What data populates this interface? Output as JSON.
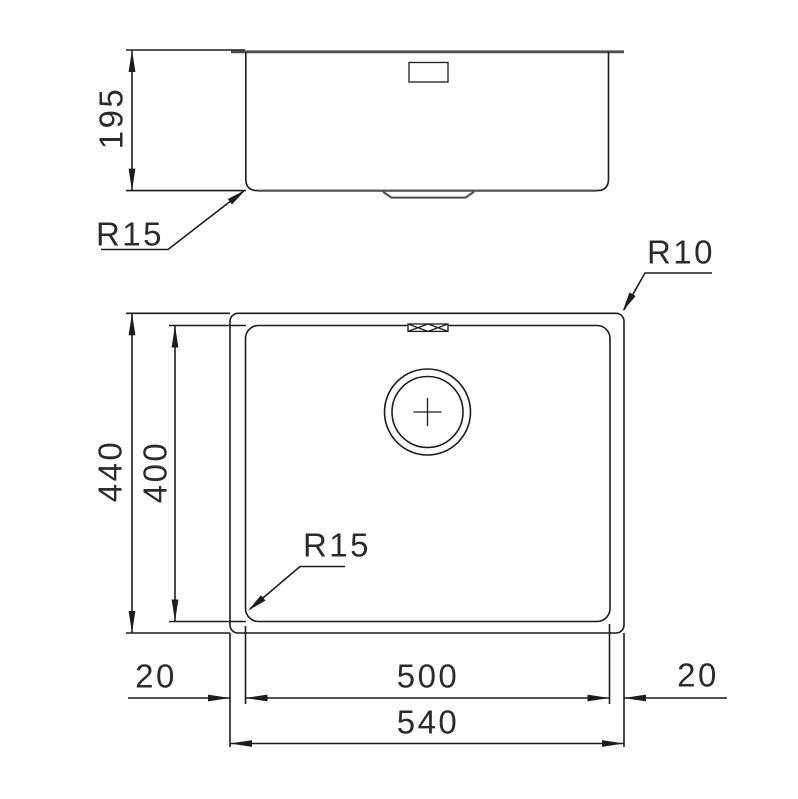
{
  "side_view": {
    "depth_label": "195",
    "corner_radius_label": "R15"
  },
  "plan_view": {
    "outer_corner_radius_label": "R10",
    "inner_corner_radius_label": "R15",
    "outer_height_label": "440",
    "inner_height_label": "400",
    "inner_width_label": "500",
    "outer_width_label": "540",
    "rim_left_label": "20",
    "rim_right_label": "20"
  },
  "colors": {
    "background": "#ffffff",
    "line": "#1c1c1c",
    "thick_line": "#4d4d4d"
  }
}
